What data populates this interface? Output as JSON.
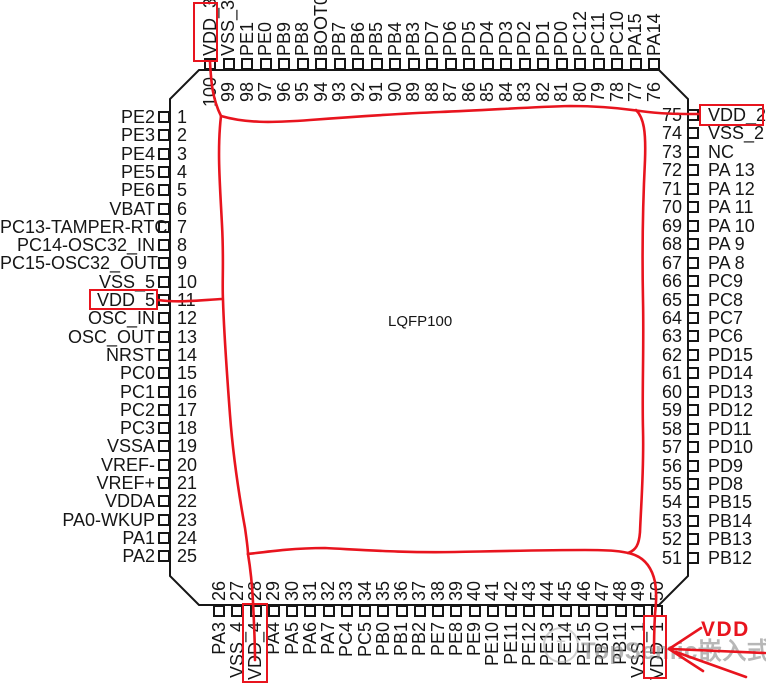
{
  "package": {
    "name": "LQFP100"
  },
  "pins": {
    "left": [
      {
        "num": 1,
        "label": "PE2"
      },
      {
        "num": 2,
        "label": "PE3"
      },
      {
        "num": 3,
        "label": "PE4"
      },
      {
        "num": 4,
        "label": "PE5"
      },
      {
        "num": 5,
        "label": "PE6"
      },
      {
        "num": 6,
        "label": "VBAT"
      },
      {
        "num": 7,
        "label": "PC13-TAMPER-RTC"
      },
      {
        "num": 8,
        "label": "PC14-OSC32_IN"
      },
      {
        "num": 9,
        "label": "PC15-OSC32_OUT"
      },
      {
        "num": 10,
        "label": "VSS_5"
      },
      {
        "num": 11,
        "label": "VDD_5"
      },
      {
        "num": 12,
        "label": "OSC_IN"
      },
      {
        "num": 13,
        "label": "OSC_OUT"
      },
      {
        "num": 14,
        "label": "NRST"
      },
      {
        "num": 15,
        "label": "PC0"
      },
      {
        "num": 16,
        "label": "PC1"
      },
      {
        "num": 17,
        "label": "PC2"
      },
      {
        "num": 18,
        "label": "PC3"
      },
      {
        "num": 19,
        "label": "VSSA"
      },
      {
        "num": 20,
        "label": "VREF-"
      },
      {
        "num": 21,
        "label": "VREF+"
      },
      {
        "num": 22,
        "label": "VDDA"
      },
      {
        "num": 23,
        "label": "PA0-WKUP"
      },
      {
        "num": 24,
        "label": "PA1"
      },
      {
        "num": 25,
        "label": "PA2"
      }
    ],
    "top": [
      {
        "num": 100,
        "label": "VDD_3"
      },
      {
        "num": 99,
        "label": "VSS_3"
      },
      {
        "num": 98,
        "label": "PE1"
      },
      {
        "num": 97,
        "label": "PE0"
      },
      {
        "num": 96,
        "label": "PB9"
      },
      {
        "num": 95,
        "label": "PB8"
      },
      {
        "num": 94,
        "label": "BOOT0"
      },
      {
        "num": 93,
        "label": "PB7"
      },
      {
        "num": 92,
        "label": "PB6"
      },
      {
        "num": 91,
        "label": "PB5"
      },
      {
        "num": 90,
        "label": "PB4"
      },
      {
        "num": 89,
        "label": "PB3"
      },
      {
        "num": 88,
        "label": "PD7"
      },
      {
        "num": 87,
        "label": "PD6"
      },
      {
        "num": 86,
        "label": "PD5"
      },
      {
        "num": 85,
        "label": "PD4"
      },
      {
        "num": 84,
        "label": "PD3"
      },
      {
        "num": 83,
        "label": "PD2"
      },
      {
        "num": 82,
        "label": "PD1"
      },
      {
        "num": 81,
        "label": "PD0"
      },
      {
        "num": 80,
        "label": "PC12"
      },
      {
        "num": 79,
        "label": "PC11"
      },
      {
        "num": 78,
        "label": "PC10"
      },
      {
        "num": 77,
        "label": "PA15"
      },
      {
        "num": 76,
        "label": "PA14"
      }
    ],
    "right": [
      {
        "num": 75,
        "label": "VDD_2"
      },
      {
        "num": 74,
        "label": "VSS_2"
      },
      {
        "num": 73,
        "label": "NC"
      },
      {
        "num": 72,
        "label": "PA 13"
      },
      {
        "num": 71,
        "label": "PA 12"
      },
      {
        "num": 70,
        "label": "PA 11"
      },
      {
        "num": 69,
        "label": "PA 10"
      },
      {
        "num": 68,
        "label": "PA 9"
      },
      {
        "num": 67,
        "label": "PA 8"
      },
      {
        "num": 66,
        "label": "PC9"
      },
      {
        "num": 65,
        "label": "PC8"
      },
      {
        "num": 64,
        "label": "PC7"
      },
      {
        "num": 63,
        "label": "PC6"
      },
      {
        "num": 62,
        "label": "PD15"
      },
      {
        "num": 61,
        "label": "PD14"
      },
      {
        "num": 60,
        "label": "PD13"
      },
      {
        "num": 59,
        "label": "PD12"
      },
      {
        "num": 58,
        "label": "PD11"
      },
      {
        "num": 57,
        "label": "PD10"
      },
      {
        "num": 56,
        "label": "PD9"
      },
      {
        "num": 55,
        "label": "PD8"
      },
      {
        "num": 54,
        "label": "PB15"
      },
      {
        "num": 53,
        "label": "PB14"
      },
      {
        "num": 52,
        "label": "PB13"
      },
      {
        "num": 51,
        "label": "PB12"
      }
    ],
    "bottom": [
      {
        "num": 26,
        "label": "PA3"
      },
      {
        "num": 27,
        "label": "VSS_4"
      },
      {
        "num": 28,
        "label": "VDD_4"
      },
      {
        "num": 29,
        "label": "PA4"
      },
      {
        "num": 30,
        "label": "PA5"
      },
      {
        "num": 31,
        "label": "PA6"
      },
      {
        "num": 32,
        "label": "PA7"
      },
      {
        "num": 33,
        "label": "PC4"
      },
      {
        "num": 34,
        "label": "PC5"
      },
      {
        "num": 35,
        "label": "PB0"
      },
      {
        "num": 36,
        "label": "PB1"
      },
      {
        "num": 37,
        "label": "PB2"
      },
      {
        "num": 38,
        "label": "PE7"
      },
      {
        "num": 39,
        "label": "PE8"
      },
      {
        "num": 40,
        "label": "PE9"
      },
      {
        "num": 41,
        "label": "PE10"
      },
      {
        "num": 42,
        "label": "PE11"
      },
      {
        "num": 43,
        "label": "PE12"
      },
      {
        "num": 44,
        "label": "PE13"
      },
      {
        "num": 45,
        "label": "PE14"
      },
      {
        "num": 46,
        "label": "PE15"
      },
      {
        "num": 47,
        "label": "PB10"
      },
      {
        "num": 48,
        "label": "PB11"
      },
      {
        "num": 49,
        "label": "VSS_1"
      },
      {
        "num": 50,
        "label": "VDD_1"
      }
    ]
  },
  "annotations": {
    "highlight_color": "#e8141e",
    "line_color": "#161616",
    "highlighted_pins": [
      "VDD_3",
      "VDD_5",
      "VDD_4",
      "VDD_1",
      "VDD_2"
    ],
    "callout_label": "VDD"
  },
  "watermark": {
    "logo": "circle-logo",
    "text": "TopSemic嵌入式"
  }
}
